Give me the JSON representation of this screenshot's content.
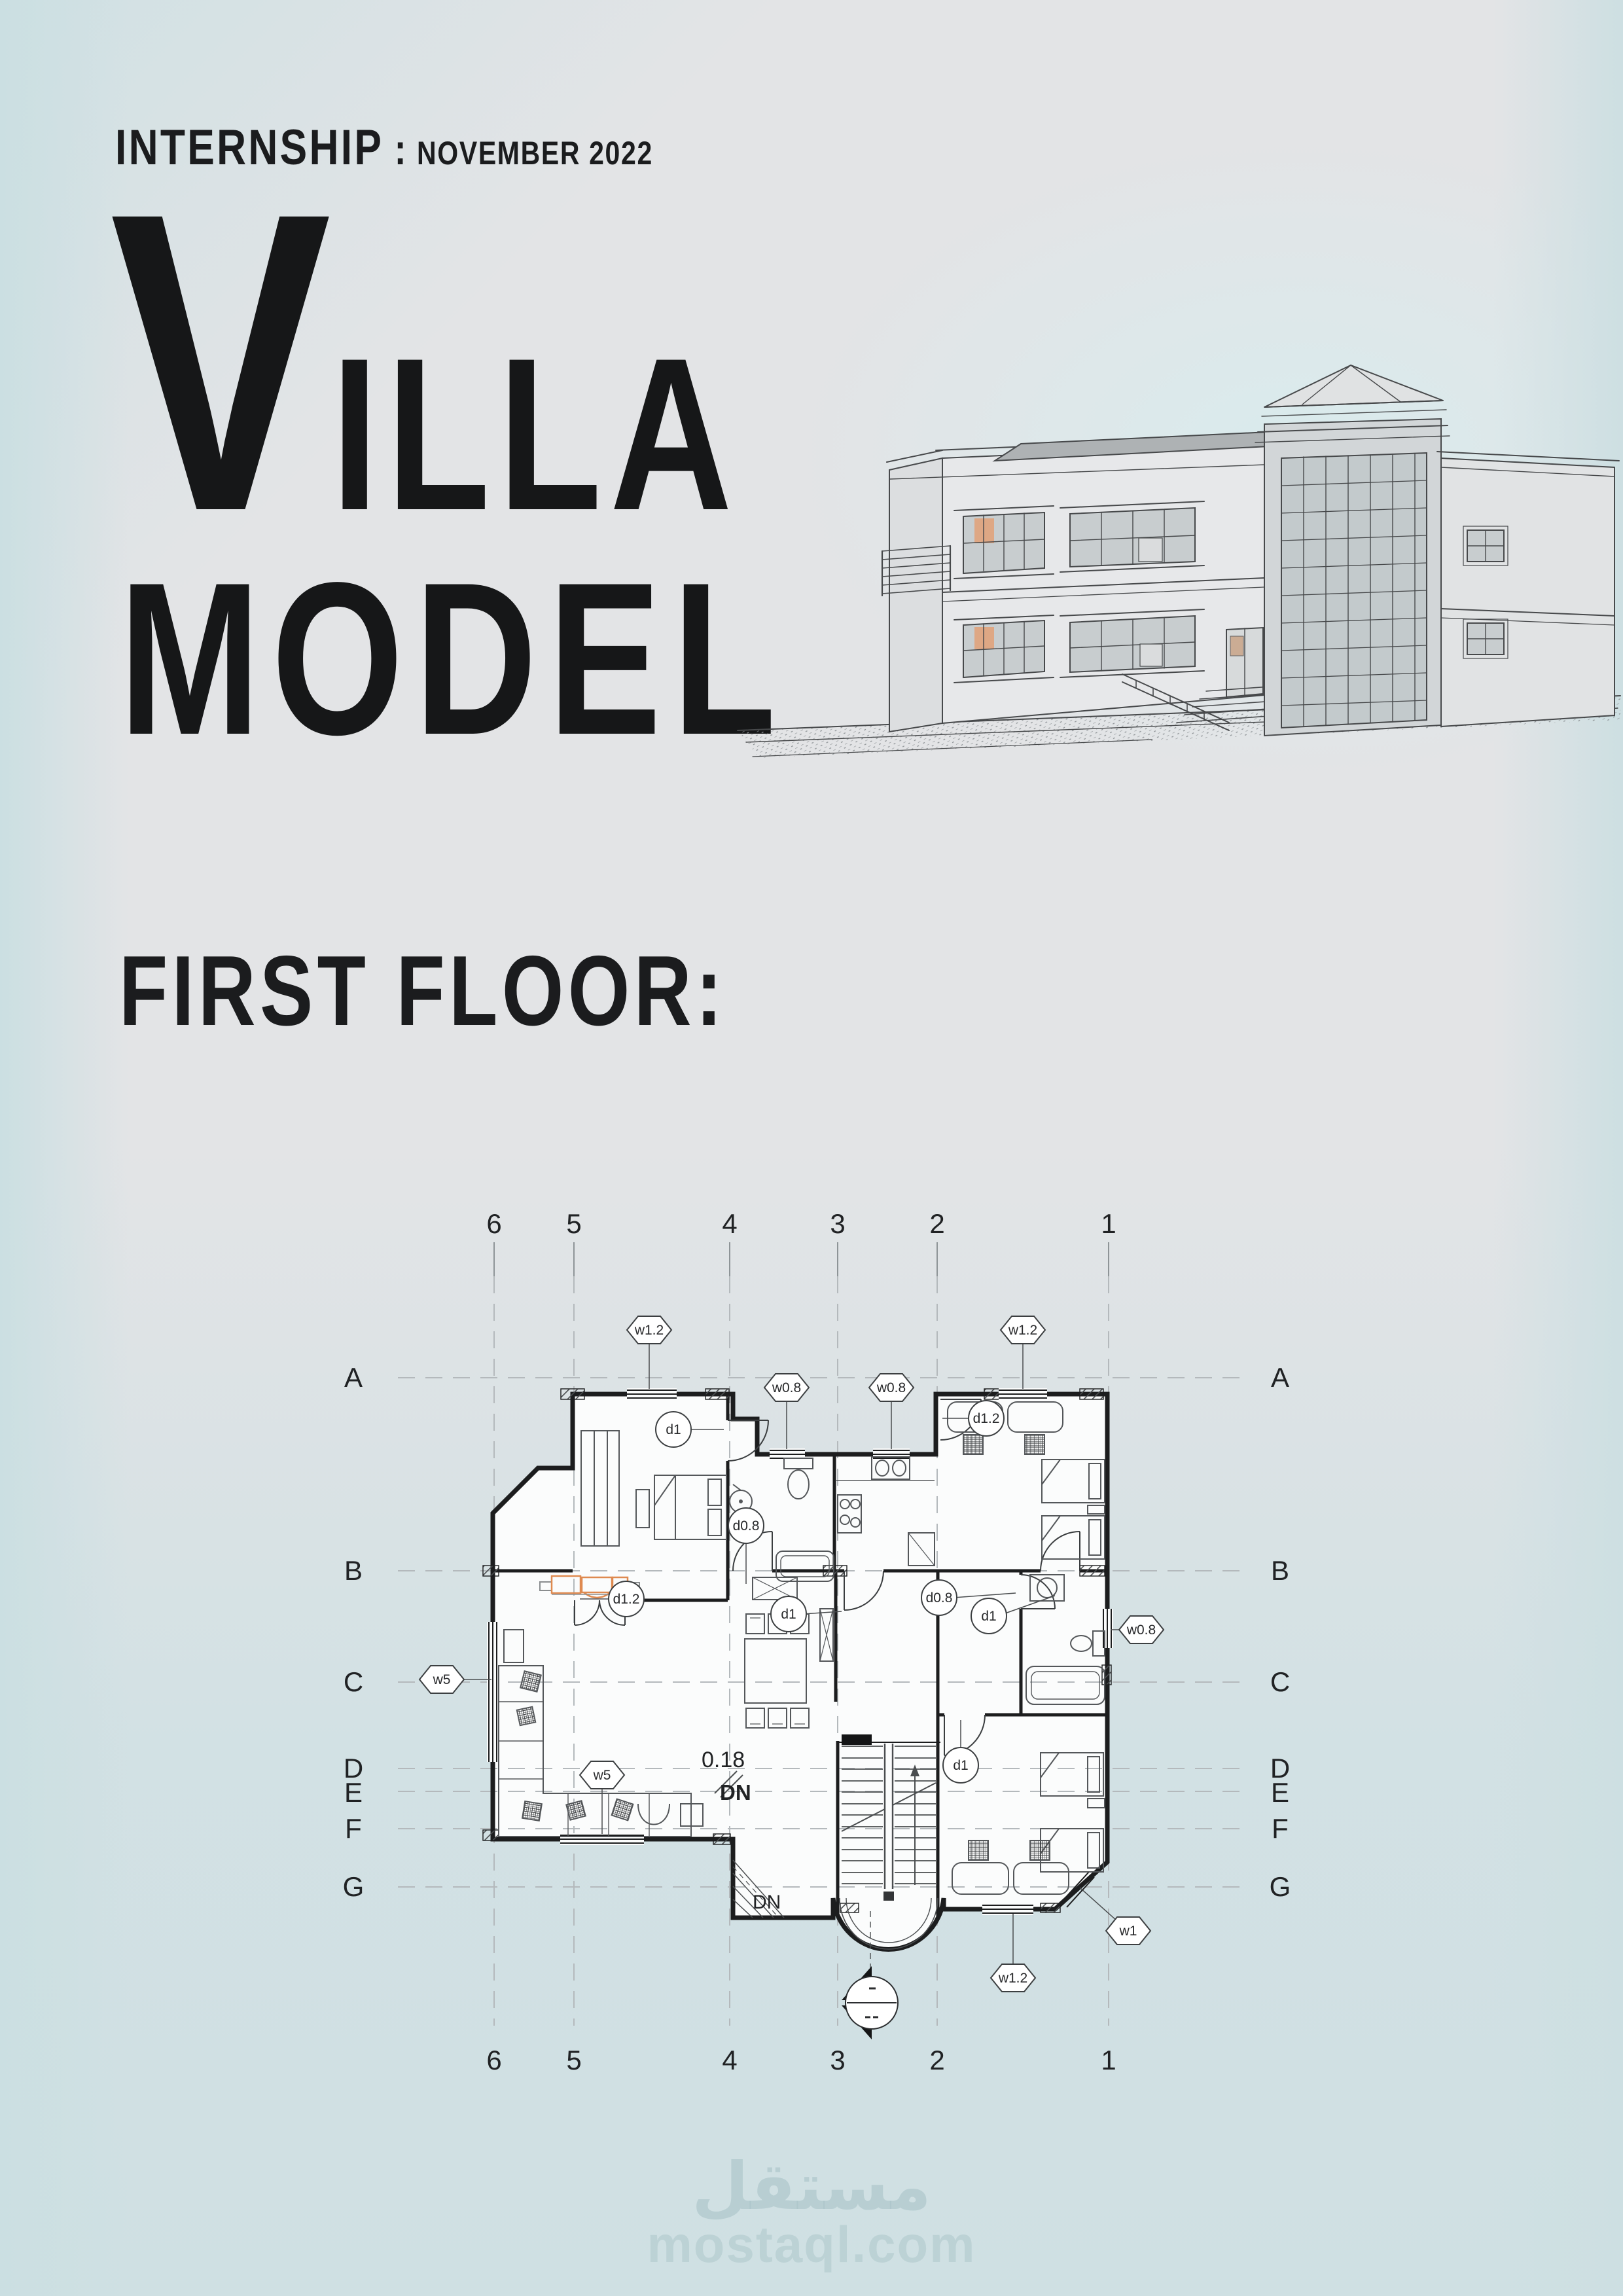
{
  "header": {
    "kicker": "INTERNSHIP",
    "separator": ":",
    "date": "NOVEMBER 2022",
    "title_initial": "V",
    "title_rest": "ILLA",
    "title_second_line": "MODEL"
  },
  "section_heading": "FIRST FLOOR:",
  "floor_plan": {
    "grid": {
      "numbers": [
        "6",
        "5",
        "4",
        "3",
        "2",
        "1"
      ],
      "letters": [
        "A",
        "B",
        "C",
        "D",
        "E",
        "F",
        "G"
      ]
    },
    "level_marker": "0.18",
    "stair_label_main": "DN",
    "stair_label_secondary": "DN",
    "window_tags": [
      {
        "label": "w1.2"
      },
      {
        "label": "w0.8"
      },
      {
        "label": "w0.8"
      },
      {
        "label": "w1.2"
      },
      {
        "label": "w0.8"
      },
      {
        "label": "w5"
      },
      {
        "label": "w5"
      },
      {
        "label": "w1"
      },
      {
        "label": "w1.2"
      }
    ],
    "door_tags": [
      {
        "label": "d1"
      },
      {
        "label": "d0.8"
      },
      {
        "label": "d1.2"
      },
      {
        "label": "d1"
      },
      {
        "label": "d0.8"
      },
      {
        "label": "d1"
      },
      {
        "label": "d1"
      },
      {
        "label": "d1.2"
      }
    ]
  },
  "watermark": {
    "arabic": "مستقل",
    "latin": "mostaql.com"
  },
  "colors": {
    "ink": "#1b1c1e",
    "wall": "#1c1d1e",
    "furniture": "#54575a",
    "accent_orange": "#df8a50",
    "grid_line": "#b4b9bc",
    "sketch": "#47494b",
    "room_fill": "#fbfcfc"
  }
}
